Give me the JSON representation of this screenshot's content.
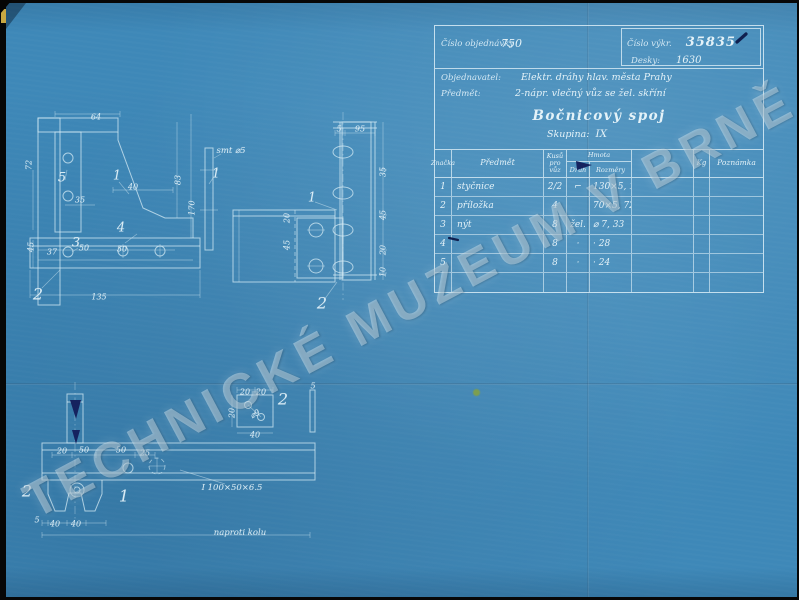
{
  "watermark": "TECHNICKÉ MUZEUM V BRNĚ",
  "colors": {
    "paper": "#3e88b8",
    "lines": "#d9eef6",
    "ink": "#15235f",
    "stain": "#86a23e"
  },
  "title_block": {
    "order_label": "Číslo objednávky",
    "order_value": "750",
    "drawing_no_label": "Číslo výkr.",
    "drawing_no_value": "35835",
    "boards_label": "Desky:",
    "boards_value": "1630",
    "customer_label": "Objednavatel:",
    "customer_value": "Elektr. dráhy hlav. města Prahy",
    "subject_label": "Předmět:",
    "subject_value": "2-nápr. vlečný vůz se žel. skříní",
    "title": "Bočnicový spoj",
    "group_label": "Skupina:",
    "group_value": "IX"
  },
  "parts_table": {
    "headers": {
      "mark": "Značka",
      "item": "Předmět",
      "qty": "Kusů pro vůz",
      "material": "Hmota",
      "kind": "Druh",
      "dims": "Rozměry",
      "kg": "Kg",
      "note": "Poznámka"
    },
    "rows": [
      {
        "mark": "1",
        "item": "styčnice",
        "qty": "2/2",
        "kind": "⌐",
        "dims": "130×5, 115",
        "extra": "",
        "kg": "",
        "note": ""
      },
      {
        "mark": "2",
        "item": "příložka",
        "qty": "4",
        "kind": "",
        "dims": "70×5, 72",
        "extra": "",
        "kg": "",
        "note": ""
      },
      {
        "mark": "3",
        "item": "nýt",
        "qty": "8",
        "kind": "žel.",
        "dims": "⌀ 7, 33",
        "extra": "",
        "kg": "",
        "note": ""
      },
      {
        "mark": "4",
        "item": "",
        "qty": "8",
        "kind": "·",
        "dims": "·  28",
        "extra": "",
        "kg": "",
        "note": ""
      },
      {
        "mark": "5",
        "item": "",
        "qty": "8",
        "kind": "·",
        "dims": "·  24",
        "extra": "",
        "kg": "",
        "note": ""
      },
      {
        "mark": "",
        "item": "",
        "qty": "",
        "kind": "",
        "dims": "",
        "extra": "",
        "kg": "",
        "note": ""
      }
    ]
  },
  "annotations": [
    {
      "t": "64",
      "x": 96,
      "y": 117,
      "cls": "dim"
    },
    {
      "t": "40",
      "x": 133,
      "y": 187,
      "cls": "dim"
    },
    {
      "t": "83",
      "x": 178,
      "y": 180,
      "r": -90,
      "cls": "dim"
    },
    {
      "t": "170",
      "x": 192,
      "y": 208,
      "r": -90,
      "cls": "dim"
    },
    {
      "t": "35",
      "x": 80,
      "y": 200,
      "cls": "dim"
    },
    {
      "t": "37",
      "x": 52,
      "y": 252,
      "cls": "dim"
    },
    {
      "t": "50",
      "x": 84,
      "y": 248,
      "cls": "dim"
    },
    {
      "t": "50",
      "x": 122,
      "y": 249,
      "cls": "dim"
    },
    {
      "t": "135",
      "x": 99,
      "y": 297,
      "cls": "dim"
    },
    {
      "t": "45",
      "x": 31,
      "y": 247,
      "r": -90,
      "cls": "dim"
    },
    {
      "t": "72",
      "x": 29,
      "y": 165,
      "r": -90,
      "cls": "dim"
    },
    {
      "t": "5",
      "x": 62,
      "y": 178,
      "cls": "callout"
    },
    {
      "t": "1",
      "x": 117,
      "y": 176,
      "cls": "callout"
    },
    {
      "t": "4",
      "x": 121,
      "y": 228,
      "cls": "callout"
    },
    {
      "t": "3",
      "x": 76,
      "y": 243,
      "cls": "callout"
    },
    {
      "t": "2",
      "x": 38,
      "y": 294,
      "cls": "callout-big"
    },
    {
      "t": "1",
      "x": 216,
      "y": 174,
      "cls": "callout"
    },
    {
      "t": "smt ⌀5",
      "x": 231,
      "y": 151,
      "cls": "note"
    },
    {
      "t": "5",
      "x": 339,
      "y": 129,
      "cls": "dim"
    },
    {
      "t": "95",
      "x": 360,
      "y": 129,
      "cls": "dim"
    },
    {
      "t": "35",
      "x": 383,
      "y": 172,
      "r": -90,
      "cls": "dim"
    },
    {
      "t": "45",
      "x": 383,
      "y": 215,
      "r": -90,
      "cls": "dim"
    },
    {
      "t": "20",
      "x": 383,
      "y": 250,
      "r": -90,
      "cls": "dim"
    },
    {
      "t": "10",
      "x": 383,
      "y": 272,
      "r": -90,
      "cls": "dim"
    },
    {
      "t": "20",
      "x": 287,
      "y": 218,
      "r": -90,
      "cls": "dim"
    },
    {
      "t": "45",
      "x": 287,
      "y": 245,
      "r": -90,
      "cls": "dim"
    },
    {
      "t": "1",
      "x": 312,
      "y": 198,
      "cls": "callout"
    },
    {
      "t": "2",
      "x": 322,
      "y": 303,
      "cls": "callout-big"
    },
    {
      "t": "20",
      "x": 62,
      "y": 451,
      "cls": "dim"
    },
    {
      "t": "50",
      "x": 84,
      "y": 450,
      "cls": "dim"
    },
    {
      "t": "50",
      "x": 121,
      "y": 450,
      "cls": "dim"
    },
    {
      "t": "25",
      "x": 145,
      "y": 453,
      "cls": "dim"
    },
    {
      "t": "5",
      "x": 37,
      "y": 520,
      "cls": "dim"
    },
    {
      "t": "40",
      "x": 55,
      "y": 524,
      "cls": "dim"
    },
    {
      "t": "40",
      "x": 76,
      "y": 524,
      "cls": "dim"
    },
    {
      "t": "I 100×50×6.5",
      "x": 232,
      "y": 488,
      "cls": "note"
    },
    {
      "t": "naproti kolu",
      "x": 240,
      "y": 533,
      "cls": "note"
    },
    {
      "t": "1",
      "x": 124,
      "y": 496,
      "cls": "callout-big"
    },
    {
      "t": "2",
      "x": 27,
      "y": 491,
      "cls": "callout-big"
    },
    {
      "t": "20",
      "x": 245,
      "y": 392,
      "cls": "dim"
    },
    {
      "t": "20",
      "x": 261,
      "y": 392,
      "cls": "dim"
    },
    {
      "t": "⌀9",
      "x": 255,
      "y": 414,
      "r": -30,
      "cls": "dim"
    },
    {
      "t": "40",
      "x": 255,
      "y": 435,
      "cls": "dim"
    },
    {
      "t": "20",
      "x": 232,
      "y": 413,
      "r": -90,
      "cls": "dim"
    },
    {
      "t": "2",
      "x": 283,
      "y": 399,
      "cls": "callout-big"
    },
    {
      "t": "5",
      "x": 313,
      "y": 386,
      "cls": "dim"
    }
  ]
}
